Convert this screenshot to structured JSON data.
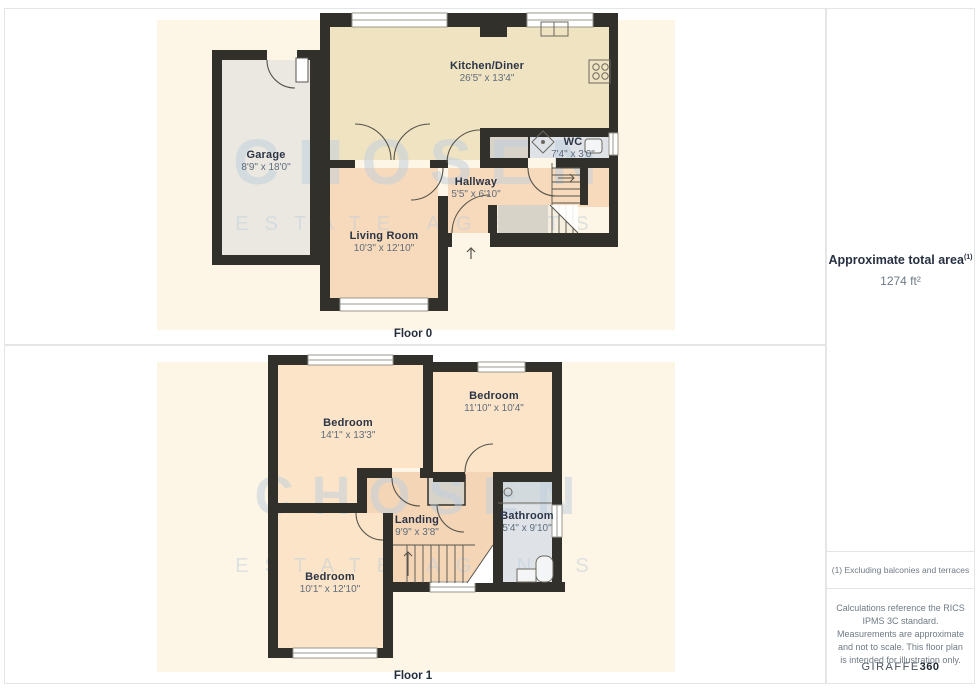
{
  "watermark": {
    "line1": "CHOSEN",
    "line2": "ESTATE AGENTS"
  },
  "floor0": {
    "label": "Floor 0",
    "rooms": {
      "kitchen": {
        "name": "Kitchen/Diner",
        "dims": "26'5\" x 13'4\""
      },
      "wc": {
        "name": "WC",
        "dims": "7'4\" x 3'0\""
      },
      "garage": {
        "name": "Garage",
        "dims": "8'9\" x 18'0\""
      },
      "hallway": {
        "name": "Hallway",
        "dims": "5'5\" x 6'10\""
      },
      "living_room": {
        "name": "Living Room",
        "dims": "10'3\" x 12'10\""
      }
    }
  },
  "floor1": {
    "label": "Floor 1",
    "rooms": {
      "bedroom_large": {
        "name": "Bedroom",
        "dims": "14'1\" x 13'3\""
      },
      "bedroom_right": {
        "name": "Bedroom",
        "dims": "11'10\" x 10'4\""
      },
      "bedroom_bottom": {
        "name": "Bedroom",
        "dims": "10'1\" x 12'10\""
      },
      "landing": {
        "name": "Landing",
        "dims": "9'9\" x 3'8\""
      },
      "bathroom": {
        "name": "Bathroom",
        "dims": "5'4\" x 9'10\""
      }
    }
  },
  "sidebar": {
    "total_area_label": "Approximate total area",
    "total_area_superscript": "(1)",
    "total_area_value": "1274 ft²",
    "footnote": "(1) Excluding balconies and terraces",
    "disclaimer": "Calculations reference the RICS IPMS 3C standard. Measurements are approximate and not to scale. This floor plan is intended for illustration only.",
    "brand": {
      "name": "GIRAFFE",
      "suffix": "360"
    }
  },
  "colors": {
    "wall": "#31302b",
    "canvas_cream": "#fdf5e5",
    "kitchen_fill": "#f0e3c1",
    "peach_fill": "#f7dabb",
    "bedroom_fill": "#fbe4c7",
    "landing_fill": "#f4d6b7",
    "garage_fill": "#ebe8e1",
    "closet_fill": "#d7d3c9",
    "bathroom_fill": "#dfe3e8",
    "watermark": "#bfcfdf"
  }
}
